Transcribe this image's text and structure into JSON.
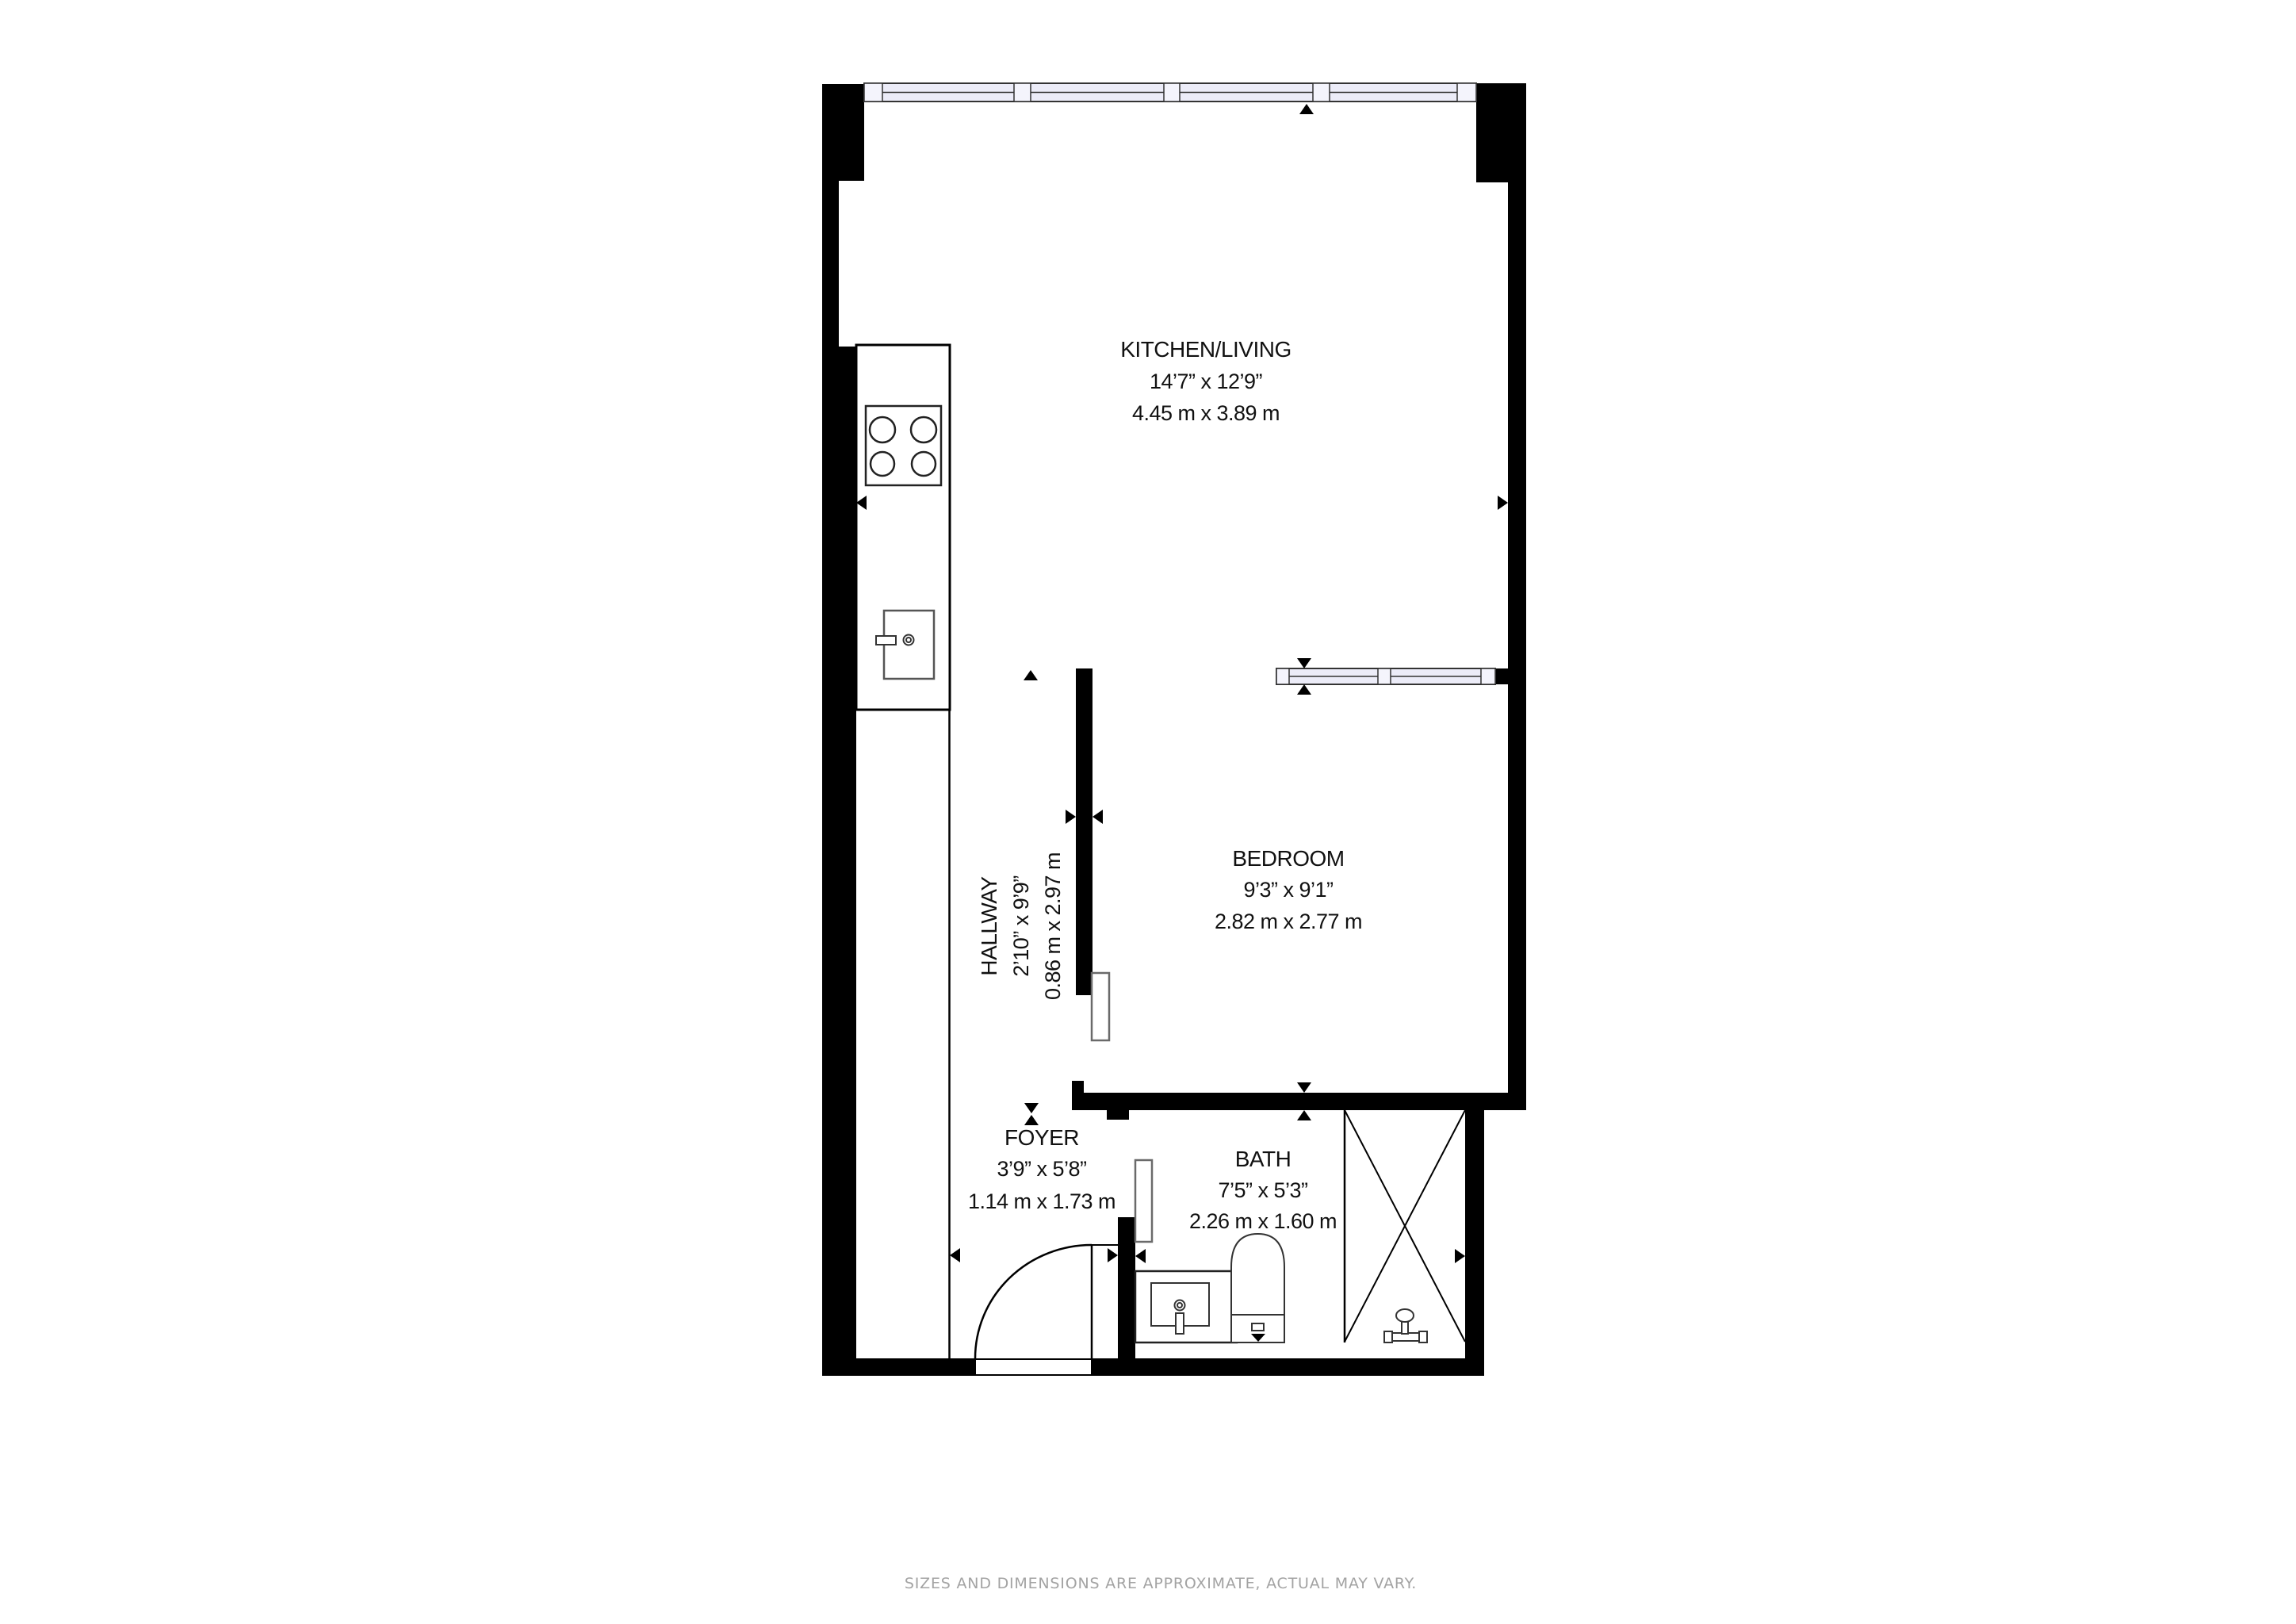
{
  "rooms": {
    "kitchen_living": {
      "name": "KITCHEN/LIVING",
      "imperial": "14’7” x 12’9”",
      "metric": "4.45 m x 3.89 m"
    },
    "bedroom": {
      "name": "BEDROOM",
      "imperial": "9’3” x 9’1”",
      "metric": "2.82 m x 2.77 m"
    },
    "hallway": {
      "name": "HALLWAY",
      "imperial": "2’10” x 9’9”",
      "metric": "0.86 m x 2.97 m"
    },
    "foyer": {
      "name": "FOYER",
      "imperial": "3’9” x 5’8”",
      "metric": "1.14 m x 1.73 m"
    },
    "bath": {
      "name": "BATH",
      "imperial": "7’5” x 5’3”",
      "metric": "2.26 m x 1.60 m"
    }
  },
  "footer": {
    "disclaimer": "SIZES AND DIMENSIONS ARE APPROXIMATE, ACTUAL MAY VARY."
  },
  "colors": {
    "wall": "#000000",
    "window_glass": "#ececf8",
    "window_frame": "#f4f4fc",
    "label_text": "#111111",
    "footer_text": "#a3a3a3",
    "background": "#ffffff"
  },
  "icons": {
    "stove": "stove-burners-icon",
    "kitchen_sink": "kitchen-sink-icon",
    "bath_sink": "vanity-sink-icon",
    "toilet": "toilet-icon",
    "shower": "shower-enclosure-icon",
    "door_swing": "door-swing-icon",
    "dimension_arrow": "dimension-arrow-icon"
  }
}
